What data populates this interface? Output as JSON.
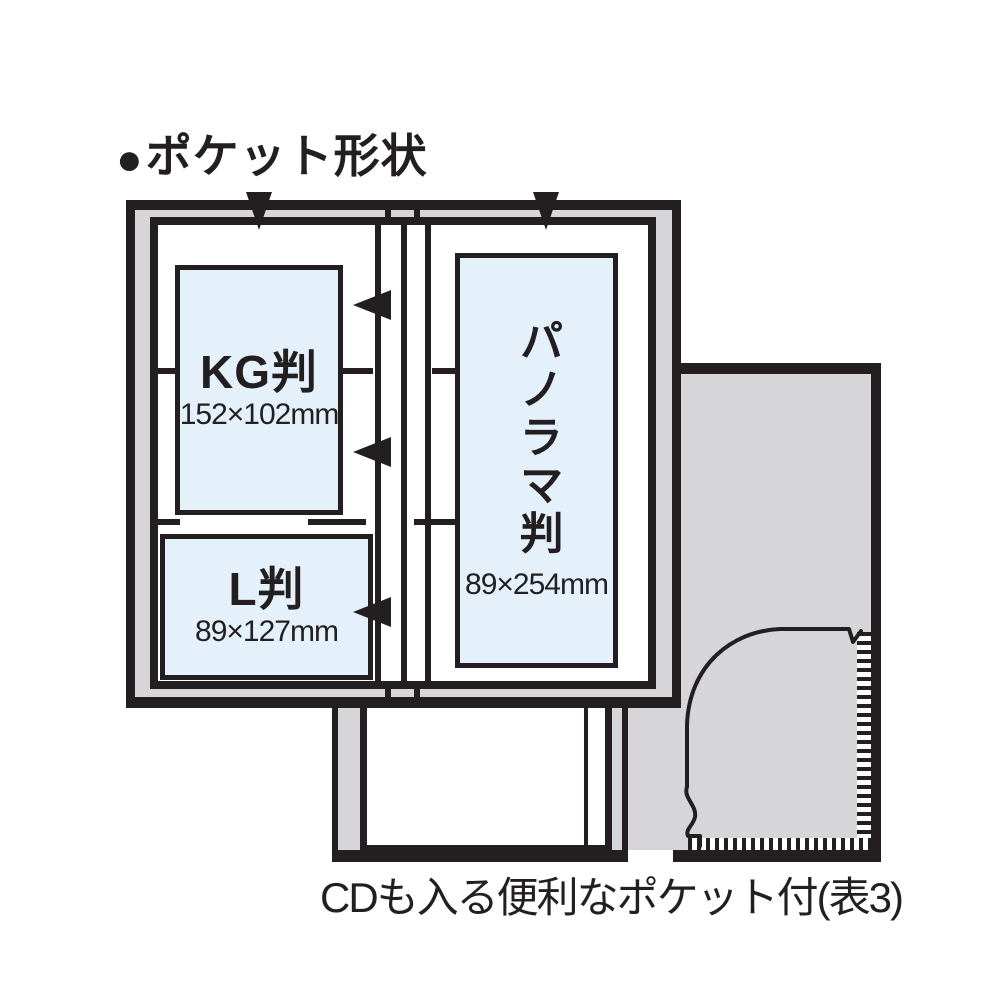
{
  "title": {
    "bullet": "●",
    "text": "ポケット形状"
  },
  "album": {
    "left_page": {
      "pockets": [
        {
          "name": "KG判",
          "size": "152×102mm"
        },
        {
          "name": "L判",
          "size": "89×127mm"
        }
      ]
    },
    "right_page": {
      "pockets": [
        {
          "name": "パノラマ判",
          "size": "89×254mm"
        }
      ]
    }
  },
  "caption": "CDも入る便利なポケット付(表3)",
  "icons": {
    "down_arrow": "insert-from-top-arrow",
    "left_arrow": "insert-from-side-arrow"
  },
  "colors": {
    "ink": "#231f20",
    "gray": "#d6d6d8",
    "pocket_blue": "#e4f1fa",
    "paper": "#ffffff"
  }
}
